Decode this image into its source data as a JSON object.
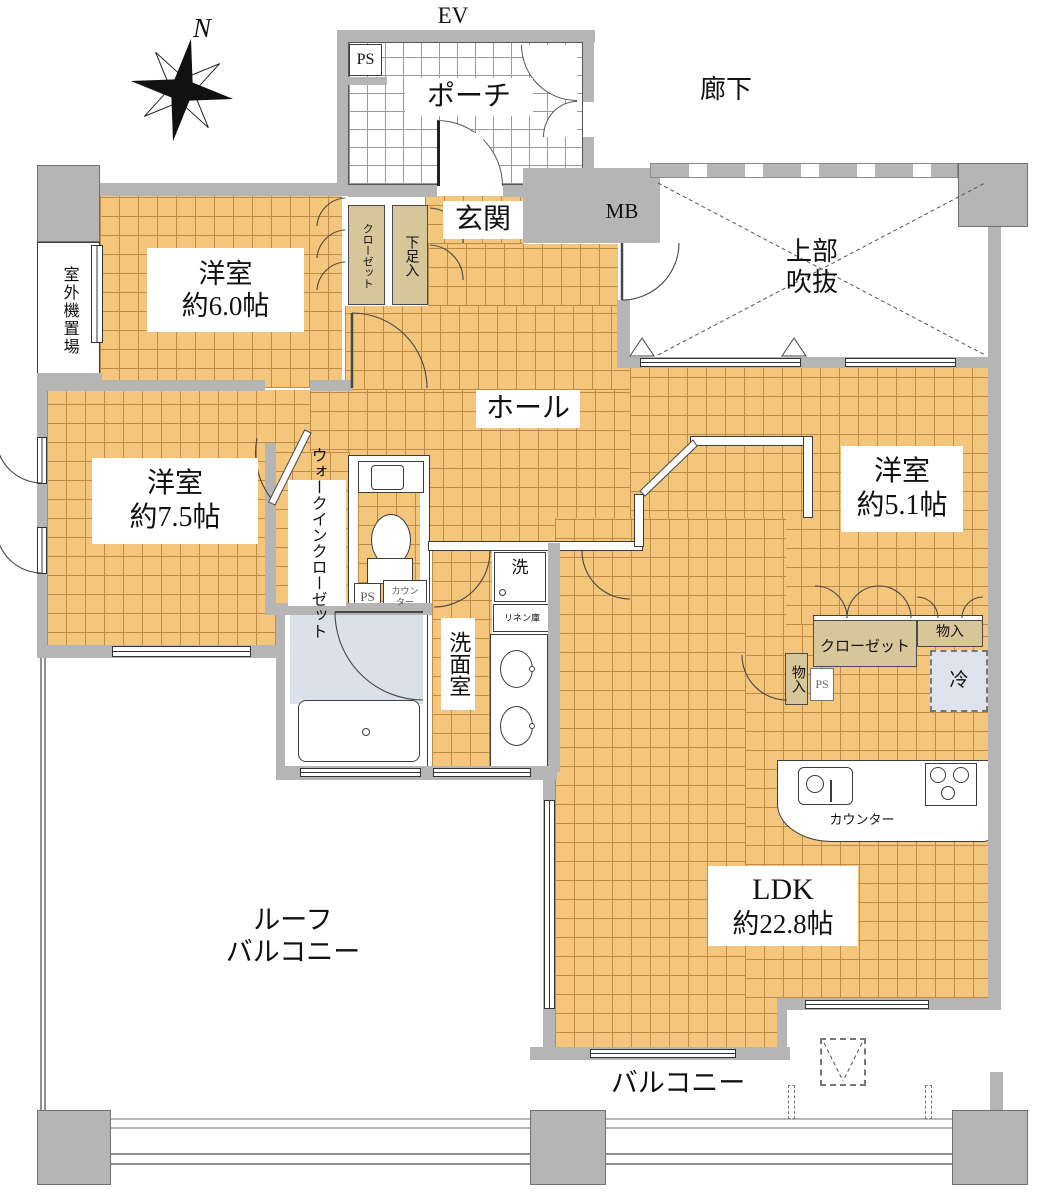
{
  "colors": {
    "floor_tile": "#F3C67C",
    "tile_grid": "#BD8C4A",
    "wall": "#B5B5B5",
    "closet_fill": "#D8C69B",
    "bath_floor": "#DBE0EA",
    "fridge_fill": "#DEE3ED"
  },
  "labels": {
    "ev": "EV",
    "ps": "PS",
    "porch": "ポーチ",
    "corridor": "廊下",
    "north": "N",
    "genkan": "玄関",
    "mb": "MB",
    "void_line1": "上部",
    "void_line2": "吹抜",
    "outdoor_unit": "室外機置場",
    "bedroom6_name": "洋室",
    "bedroom6_size": "約6.0帖",
    "closet_vertical": "クローゼット",
    "shoe_box": "下足入",
    "hall": "ホール",
    "bedroom75_name": "洋室",
    "bedroom75_size": "約7.5帖",
    "wic_line1": "ウォークイン",
    "wic_line2": "クローゼット",
    "toilet_counter_line1": "カウン",
    "toilet_counter_line2": "ター",
    "washer": "洗",
    "linen": "リネン庫",
    "washroom": "洗面室",
    "bedroom51_name": "洋室",
    "bedroom51_size": "約5.1帖",
    "closet51": "クローゼット",
    "storage_h": "物入",
    "storage_v": "物入",
    "fridge": "冷",
    "kitchen_counter": "カウンター",
    "ldk_name": "LDK",
    "ldk_size": "約22.8帖",
    "roof_balcony_line1": "ルーフ",
    "roof_balcony_line2": "バルコニー",
    "balcony": "バルコニー"
  }
}
